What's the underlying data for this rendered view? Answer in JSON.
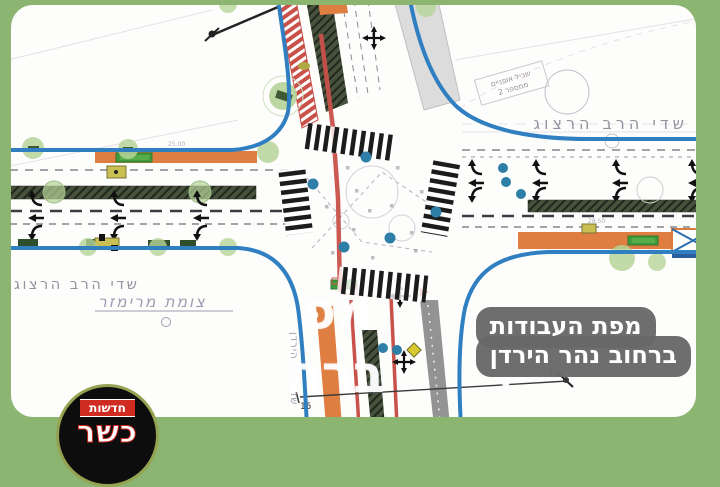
{
  "frame": {
    "background_green": "#8cb572",
    "card_background": "#fdfdfc"
  },
  "map": {
    "colors": {
      "curb_blue": "#2f7fc1",
      "works_orange": "#df7e41",
      "rail_red": "#c8514a",
      "median_dark_green": "#46523c",
      "tree_green": "#b6d398",
      "signal_teal": "#2e7fa8",
      "sign_green": "#3f9b3d",
      "cad_text_gray": "#8d8595"
    },
    "labels": {
      "street_right": "שדי הרב הרצוג",
      "street_left": "שדי הרב הרצוג",
      "junction": "צומת מרימזר",
      "street_south": "שד' נהר הירדן",
      "bike_note_line1": "שביל אופניים",
      "bike_note_line2": "ממספר 2",
      "dim_left": "15",
      "dim_right": "15",
      "dim_small_west": "25.00",
      "dim_small_east": "28.50"
    }
  },
  "watermark": {
    "frag_line1": "מפ",
    "frag_line2": "ברח",
    "frag_tail1": "ת",
    "frag_tail2": "ן"
  },
  "caption": {
    "line1": "מפת העבודות",
    "line2": "ברחוב נהר הירדן",
    "background": "#686868"
  },
  "logo": {
    "kicker": "חדשות",
    "brand": "כשר"
  }
}
